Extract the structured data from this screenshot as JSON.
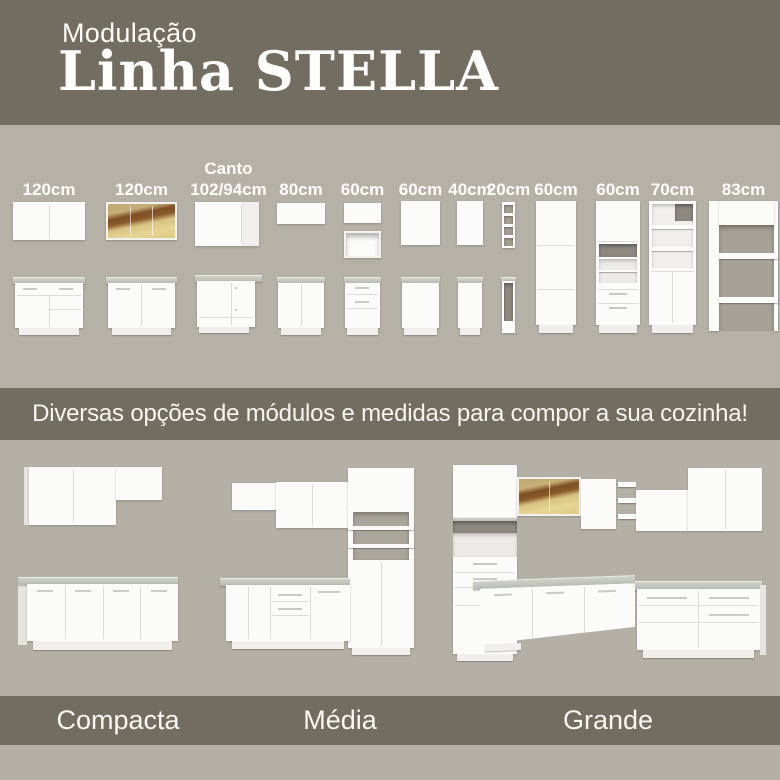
{
  "header": {
    "kicker": "Modulação",
    "title": "Linha STELLA"
  },
  "modules": {
    "items": [
      {
        "label": "120cm"
      },
      {
        "label": "120cm"
      },
      {
        "label_top": "Canto",
        "label": "102/94cm"
      },
      {
        "label": "80cm"
      },
      {
        "label": "60cm"
      },
      {
        "label": "60cm"
      },
      {
        "label": "40cm"
      },
      {
        "label": "20cm"
      },
      {
        "label": "60cm"
      },
      {
        "label": "60cm"
      },
      {
        "label": "70cm"
      },
      {
        "label": "83cm"
      }
    ]
  },
  "banner": {
    "text": "Diversas opções de módulos e medidas para compor a sua cozinha!"
  },
  "kitchens": {
    "items": [
      {
        "name": "Compacta"
      },
      {
        "name": "Média"
      },
      {
        "name": "Grande"
      }
    ]
  },
  "colors": {
    "band_background": "#726d60",
    "section_background": "#b6b1a7",
    "cabinet_white": "#fbfbfa",
    "countertop_gray": "#bfc3ba",
    "glass_amber": "#d8c382",
    "glass_wood_brown": "#8a5a2b",
    "text_white": "#fdfdfb"
  }
}
